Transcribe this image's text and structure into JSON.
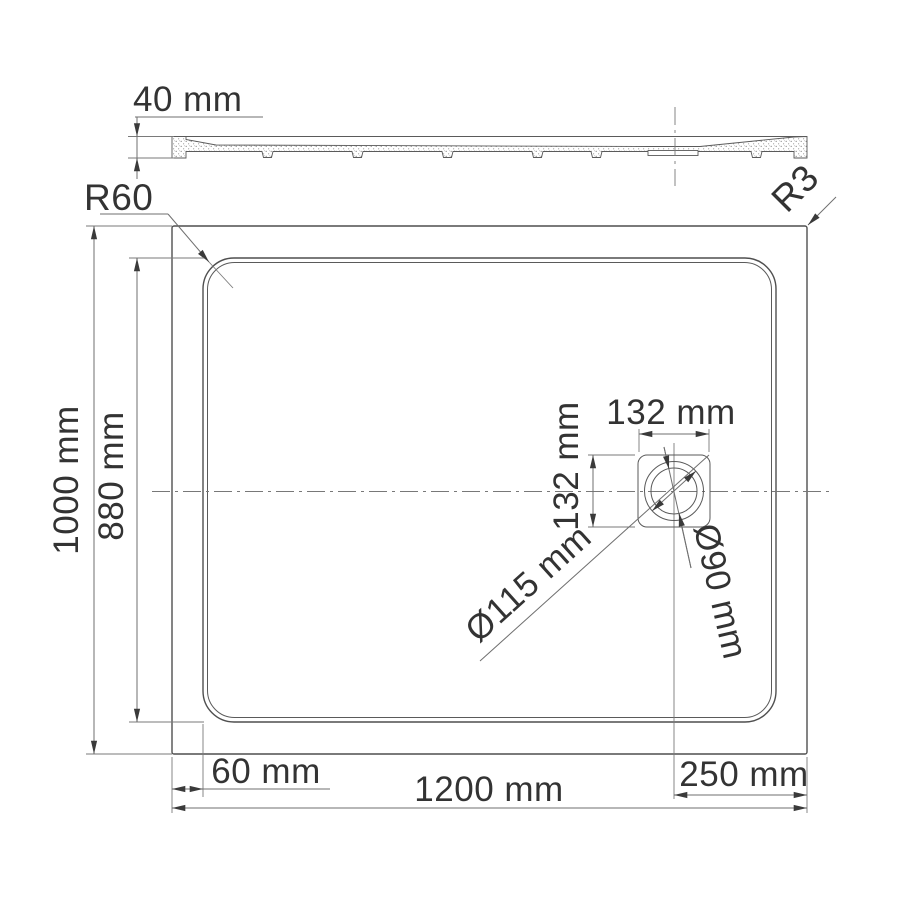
{
  "labels": {
    "profile_thickness": "40 mm",
    "corner_radius": "R60",
    "edge_radius": "R3",
    "overall_height": "1000 mm",
    "inner_height": "880 mm",
    "rim_width": "60 mm",
    "overall_width": "1200 mm",
    "drain_offset": "250 mm",
    "drain_square_width": "132 mm",
    "drain_square_height": "132 mm",
    "drain_outer_diameter": "Ø115 mm",
    "drain_inner_diameter": "Ø90 mm"
  },
  "units": "mm",
  "colors": {
    "object_line": "#4f4f4f",
    "dimension_line": "#6f6f6f",
    "text": "#333333"
  }
}
